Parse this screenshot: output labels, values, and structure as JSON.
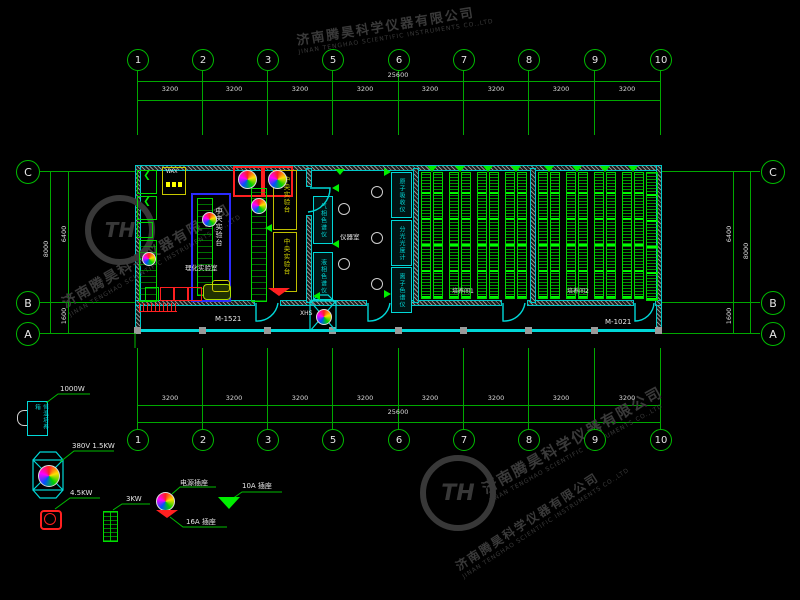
{
  "axes": {
    "top": [
      "1",
      "2",
      "3",
      "5",
      "6",
      "7",
      "8",
      "9",
      "10"
    ],
    "bottom": [
      "1",
      "2",
      "3",
      "5",
      "6",
      "7",
      "8",
      "9",
      "10"
    ],
    "left": [
      "C",
      "B",
      "A"
    ],
    "right": [
      "C",
      "B",
      "A"
    ]
  },
  "dims": {
    "total_top": "25600",
    "total_bottom": "25600",
    "bays_top": [
      "3200",
      "3200",
      "3200",
      "3200",
      "3200",
      "3200",
      "3200",
      "3200"
    ],
    "bays_bottom": [
      "3200",
      "3200",
      "3200",
      "3200",
      "3200",
      "3200",
      "3200",
      "3200"
    ],
    "left": {
      "overall": "8000",
      "cb": "6400",
      "ba": "1600"
    },
    "right": {
      "overall": "8000",
      "cb": "6400",
      "ba": "1600"
    }
  },
  "plan": {
    "rooms": {
      "lab": "理化实验室",
      "instrument": "仪器室",
      "culture1": "培养间1",
      "culture2": "培养间2"
    },
    "bench_label": "中央实验台",
    "wax": "WAX",
    "doors": {
      "left": "M-1521",
      "right": "M-1021"
    },
    "shaft": "XHS",
    "instruments": [
      "气相色谱仪",
      "液相色谱仪",
      "原子吸收仪",
      "分光光度计",
      "离子色谱仪"
    ]
  },
  "legend": {
    "incubator": "恒温培养箱",
    "items": [
      {
        "label": "1000W"
      },
      {
        "label": "380V 1.5KW"
      },
      {
        "label": "4.5KW"
      },
      {
        "label": "3KW"
      },
      {
        "label": "电源插座"
      },
      {
        "label": "16A 插座"
      },
      {
        "label": "10A 插座"
      }
    ]
  },
  "watermark": {
    "cn": "济南腾昊科学仪器有限公司",
    "en": "JINAN TENGHAO SCIENTIFIC INSTRUMENTS CO.,LTD",
    "logo": "TH"
  },
  "colors": {
    "line_green": "#00a800",
    "bright_green": "#00ff00",
    "wall_cyan": "#00d8d8",
    "dim_text": "#d9d9d9",
    "red": "#ff2020",
    "yellow": "#d8d800",
    "blue": "#2b2bff",
    "watermark": "#3a3a3a"
  }
}
